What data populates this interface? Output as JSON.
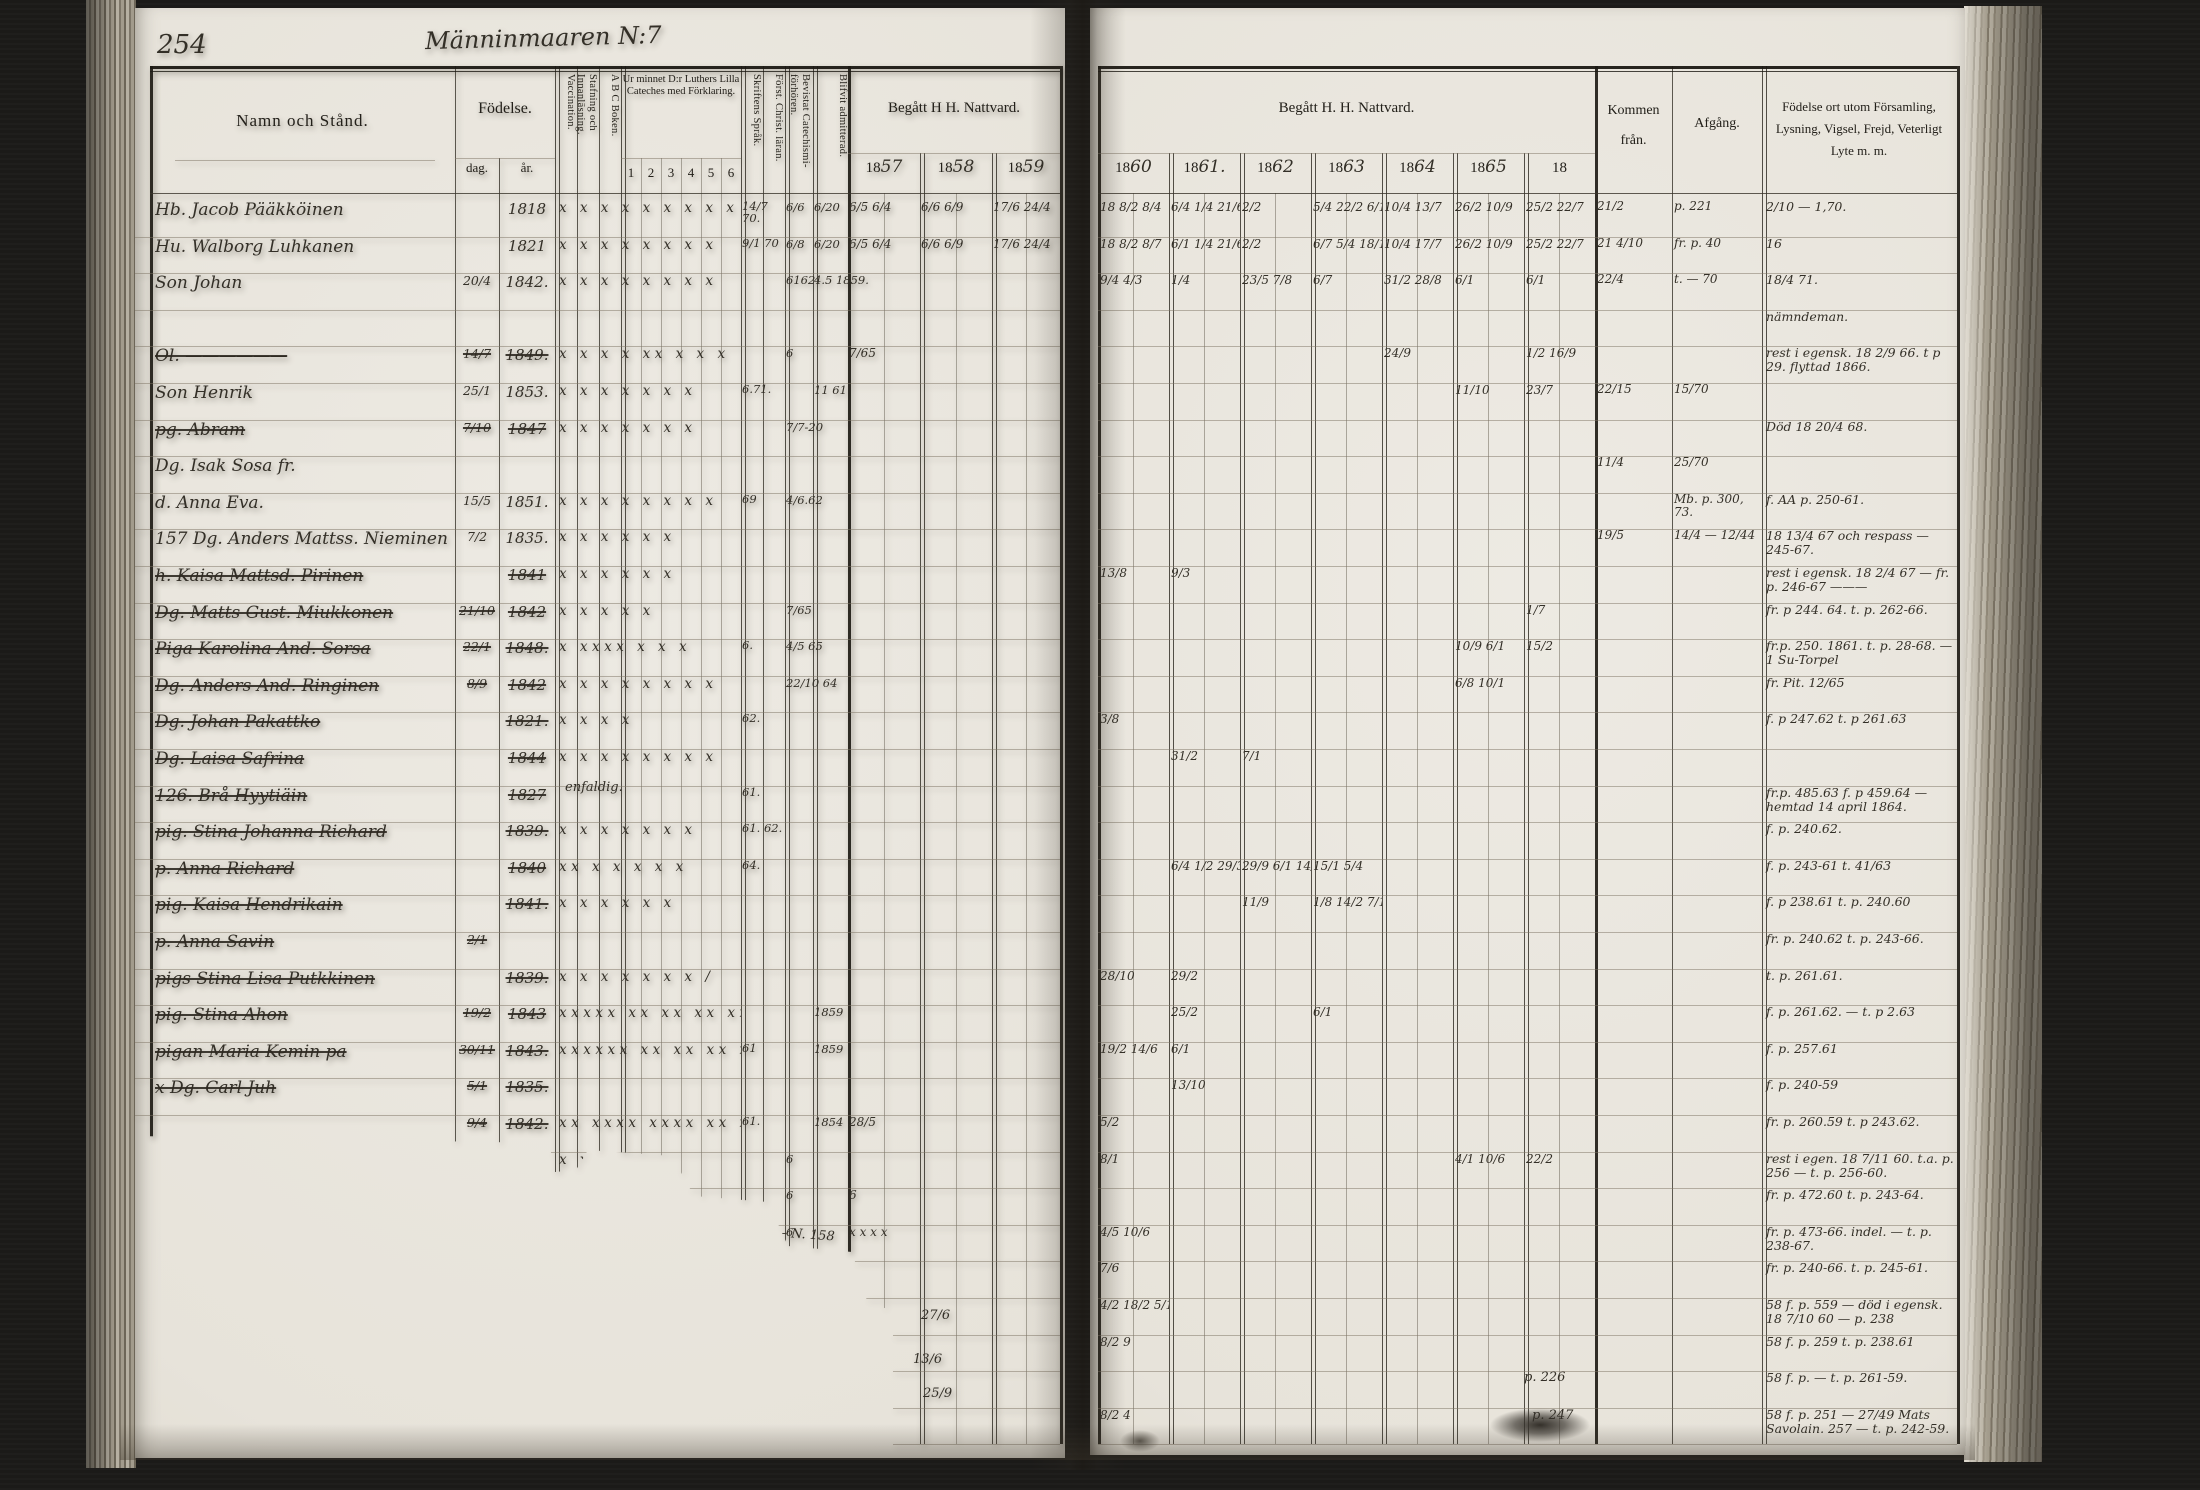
{
  "scan": {
    "page_number": "254",
    "handwritten_title": "Männinmaaren N:7"
  },
  "left_header": {
    "namn": "Namn och Stånd.",
    "fodelse": "Födelse.",
    "dag": "dag.",
    "ar": "år.",
    "vaccination": "Vaccination.",
    "stafning": "Stafning och Innanläsning.",
    "abc": "A B C Boken.",
    "cateches": "Ur minnet D:r Luthers Lilla Cateches med Förklaring.",
    "cateches_cols": [
      "1",
      "2",
      "3",
      "4",
      "5",
      "6"
    ],
    "skriftens": "Skriftens Språk.",
    "forst": "Först. Christ. läran.",
    "bevistat": "Bevistat Catechismi-förhören.",
    "blifvit": "Blifvit admitterad.",
    "nattvard": "Begått H  H. Nattvard.",
    "years": [
      {
        "p": "18",
        "w": "57"
      },
      {
        "p": "18",
        "w": "58"
      },
      {
        "p": "18",
        "w": "59"
      }
    ]
  },
  "right_header": {
    "nattvard": "Begått H. H. Nattvard.",
    "years": [
      {
        "p": "18",
        "w": "60"
      },
      {
        "p": "18",
        "w": "61."
      },
      {
        "p": "18",
        "w": "62"
      },
      {
        "p": "18",
        "w": "63"
      },
      {
        "p": "18",
        "w": "64"
      },
      {
        "p": "18",
        "w": "65"
      },
      {
        "p": "18",
        "w": ""
      }
    ],
    "kommen": "Kommen från.",
    "afgang": "Afgång.",
    "notes": "Födelse ort utom Församling, Lysning, Vigsel, Frejd, Veterligt Lyte m. m."
  },
  "left_rows": [
    {
      "name": "Hb. Jacob Pääkköinen",
      "ar": "1818",
      "marks": "x x x x x x x x x",
      "sk": "14/7 70.",
      "bev": "6/6",
      "adm": "6/20",
      "n57": "6/5 6/4",
      "n58": "6/6 6/9",
      "n59": "17/6 24/4"
    },
    {
      "name": "Hu. Walborg Luhkanen",
      "ar": "1821",
      "marks": "x x  x x x x x  x",
      "sk": "9/1 70",
      "bev": "6/8",
      "adm": "6/20",
      "n57": "6/5 6/4",
      "n58": "6/6 6/9",
      "n59": "17/6 24/4"
    },
    {
      "name": "Son Johan",
      "dag": "20/4",
      "ar": "1842.",
      "marks": "x   x x x x x  x  x",
      "bev": "6162",
      "adm": "4.5  1859."
    },
    {},
    {
      "name": "Ol. ——————",
      "struck": true,
      "dag": "14/7",
      "ar": "1849.",
      "marks": "x x x x xx x x x",
      "bev": "6",
      "n57": "7/65"
    },
    {
      "name": "Son Henrik",
      "dag": "25/1",
      "ar": "1853.",
      "marks": "x x x x  x x  x",
      "sk": "6.71.",
      "adm": "11 61"
    },
    {
      "name": "pg. Abram",
      "struck": true,
      "dag": "7/10",
      "ar": "1847",
      "marks": "x x x x x x x",
      "bev": "7/7-20"
    },
    {
      "name": "Dg. Isak Sosa fr."
    },
    {
      "name": "d. Anna  Eva.",
      "dag": "15/5",
      "ar": "1851.",
      "marks": "x  x x x x  x x  x",
      "sk": "69",
      "bev": "4/6.62"
    },
    {
      "name": "157 Dg. Anders Mattss. Nieminen ibf.",
      "dag": "7/2",
      "ar": "1835.",
      "marks": "x  x x x x  x"
    },
    {
      "name": "h. Kaisa Mattsd. Pirinen",
      "struck": true,
      "ar": "1841",
      "marks": "x  x x x x  x"
    },
    {
      "name": "Dg. Matts Gust. Miukkonen",
      "struck": true,
      "dag": "21/10",
      "ar": "1842",
      "marks": "x x x x x",
      "bev": "7/65"
    },
    {
      "name": "Piga Karolina And. Sorsa",
      "struck": true,
      "dag": "22/1",
      "ar": "1848.",
      "marks": "x xxxx x x x",
      "sk": "6.",
      "bev": "4/5 65"
    },
    {
      "name": "Dg. Anders And. Ringinen",
      "struck": true,
      "dag": "8/9",
      "ar": "1842",
      "marks": "x x x x x x x x",
      "bev": "22/10 64"
    },
    {
      "name": "Dg. Johan Pakattko",
      "struck": true,
      "ar": "1821.",
      "marks": "x x x x",
      "sk": "62."
    },
    {
      "name": "Dg. Laisa Safrina",
      "struck": true,
      "ar": "1844",
      "marks": "x x x x x x x x"
    },
    {
      "name": "126. Brå Hyytiäin",
      "struck": true,
      "ar": "1827",
      "sk": "61."
    },
    {
      "name": "pig. Stina Johanna Richard",
      "struck": true,
      "ar": "1839.",
      "marks": "x x x x x x x",
      "sk": "61. 62."
    },
    {
      "name": "p. Anna Richard",
      "struck": true,
      "ar": "1840",
      "marks": "xx x x x x  x",
      "sk": "64."
    },
    {
      "name": "pig. Kaisa Hendrikain",
      "struck": true,
      "ar": "1841.",
      "marks": "x x x x x x"
    },
    {
      "name": "p. Anna Savin",
      "struck": true,
      "dag": "2/1"
    },
    {
      "name": "pigs Stina Lisa Putkkinen",
      "struck": true,
      "ar": "1839.",
      "marks": "x x x x x x x  /"
    },
    {
      "name": "pig. Stina Ahon",
      "struck": true,
      "dag": "19/2",
      "ar": "1843",
      "marks": "xxxxx xx xx xx xx xxx",
      "adm": "1859"
    },
    {
      "name": "pigan Maria Kemin pa",
      "struck": true,
      "dag": "30/11",
      "ar": "1843.",
      "marks": "xxxxxx xx xx xx xx x",
      "sk": "61",
      "adm": "1859"
    },
    {
      "name": "x Dg. Carl Juh",
      "struck": true,
      "dag": "5/1",
      "ar": "1835."
    },
    {
      "struck": true,
      "dag": "9/4",
      "ar": "1842.",
      "marks": "xx xxxx xxxx xx xxx",
      "sk": "61.",
      "adm": "1854",
      "n57": "28/5"
    },
    {
      "marks": "x x x x x x",
      "bev": "6"
    },
    {
      "marks": "x x x x x",
      "bev": "6",
      "n57": "6"
    },
    {
      "bev": "6",
      "n57": "x x x x"
    },
    {},
    {},
    {},
    {},
    {}
  ],
  "right_rows": [
    {
      "y0": "18 8/2 8/4",
      "y1": "6/4 1/4 21/6",
      "y2": "2/2",
      "y3": "5/4 22/2 6/1",
      "y4": "10/4 13/7",
      "y5": "26/2 10/9",
      "y6": "25/2 22/7",
      "kommen": "21/2",
      "afg": "p. 221",
      "note": "2/10 — 1,70."
    },
    {
      "y0": "18 8/2 8/7",
      "y1": "6/1 1/4 21/6",
      "y2": "2/2",
      "y3": "6/7 5/4 18/10",
      "y4": "10/4 17/7",
      "y5": "26/2 10/9",
      "y6": "25/2 22/7",
      "kommen": "21 4/10",
      "afg": "fr. p. 40",
      "note": "16"
    },
    {
      "y0": "9/4 4/3",
      "y1": "1/4",
      "y2": "23/5 7/8",
      "y3": "6/7",
      "y4": "31/2 28/8",
      "y5": "6/1",
      "y6": "6/1",
      "kommen": "22/4",
      "afg": "t. — 70",
      "note": "18/4 71."
    },
    {
      "note": "nämndeman."
    },
    {
      "y4": "24/9",
      "y6": "1/2 16/9",
      "note": "rest i egensk. 18 2/9 66. t p 29. flyttad 1866."
    },
    {
      "y5": "11/10",
      "y6": "23/7",
      "kommen": "22/15",
      "afg": "15/70"
    },
    {
      "note": "Död 18 20/4 68."
    },
    {
      "kommen": "11/4",
      "afg": "25/70"
    },
    {
      "afg": "Mb. p. 300, 73.",
      "note": "f. AA p. 250-61."
    },
    {
      "kommen": "19/5",
      "afg": "14/4 — 12/44",
      "note": "18 13/4 67 och respass — 245-67."
    },
    {
      "y0": "13/8",
      "y1": "9/3",
      "note": "rest i egensk. 18 2/4 67 — fr. p. 246-67 ———"
    },
    {
      "y6": "1/7",
      "note": "fr. p 244. 64.  t. p. 262-66."
    },
    {
      "y5": "10/9 6/1",
      "y6": "15/2",
      "note": "fr.p. 250. 1861. t. p. 28-68. — 1 Su-Torpel"
    },
    {
      "y5": "6/8 10/1",
      "note": "fr. Pit. 12/65"
    },
    {
      "y0": "3/8",
      "note": "f. p 247.62  t. p 261.63"
    },
    {
      "y1": "31/2",
      "y2": "7/1"
    },
    {
      "note": "fr.p. 485.63  f. p 459.64 — hemtad 14 april 1864."
    },
    {
      "note": "f. p. 240.62."
    },
    {
      "y1": "6/4 1/2 29/3",
      "y2": "29/9 6/1 14/6",
      "y3": "15/1 5/4",
      "note": "f. p. 243-61  t. 41/63"
    },
    {
      "y2": "11/9",
      "y3": "1/8 14/2 7/1",
      "note": "f. p 238.61  t. p. 240.60"
    },
    {
      "note": "fr. p. 240.62  t. p. 243-66."
    },
    {
      "y0": "28/10",
      "y1": "29/2",
      "note": "t. p. 261.61."
    },
    {
      "y1": "25/2",
      "y3": "6/1",
      "note": "f. p. 261.62. — t. p 2.63"
    },
    {
      "y0": "19/2 14/6",
      "y1": "6/1",
      "note": "f. p. 257.61"
    },
    {
      "y1": "13/10",
      "note": "f. p. 240-59"
    },
    {
      "y0": "5/2",
      "note": "fr. p. 260.59  t. p 243.62."
    },
    {
      "y0": "8/1",
      "y5": "4/1 10/6",
      "y6": "22/2",
      "note": "rest i egen. 18 7/11 60. t.a. p. 256 — t. p. 256-60."
    },
    {
      "note": "fr. p. 472.60  t. p. 243-64."
    },
    {
      "y0": "4/5 10/6",
      "note": "fr. p. 473-66. indel. — t. p. 238-67."
    },
    {
      "y0": "7/6",
      "note": "fr. p. 240-66.  t. p. 245-61."
    },
    {
      "y0": "4/2 18/2 5/1",
      "note": "58 f. p. 559 — död i egensk. 18 7/10 60 — p. 238"
    },
    {
      "y0": "8/2 9",
      "note": "58 f. p. 259  t. p. 238.61"
    },
    {
      "note": "58 f. p. — t. p. 261-59."
    },
    {
      "y0": "8/2 4",
      "note": "58 f. p. 251 — 27/49 Mats Savolain. 257 — t. p. 242-59."
    }
  ],
  "fragments": [
    {
      "text": "enfaldig."
    },
    {
      "text": "———— N. 158"
    },
    {
      "text": "27/6"
    },
    {
      "text": "13/6"
    },
    {
      "text": "25/9"
    },
    {
      "text": "p. 226"
    },
    {
      "text": "p. 247"
    }
  ]
}
